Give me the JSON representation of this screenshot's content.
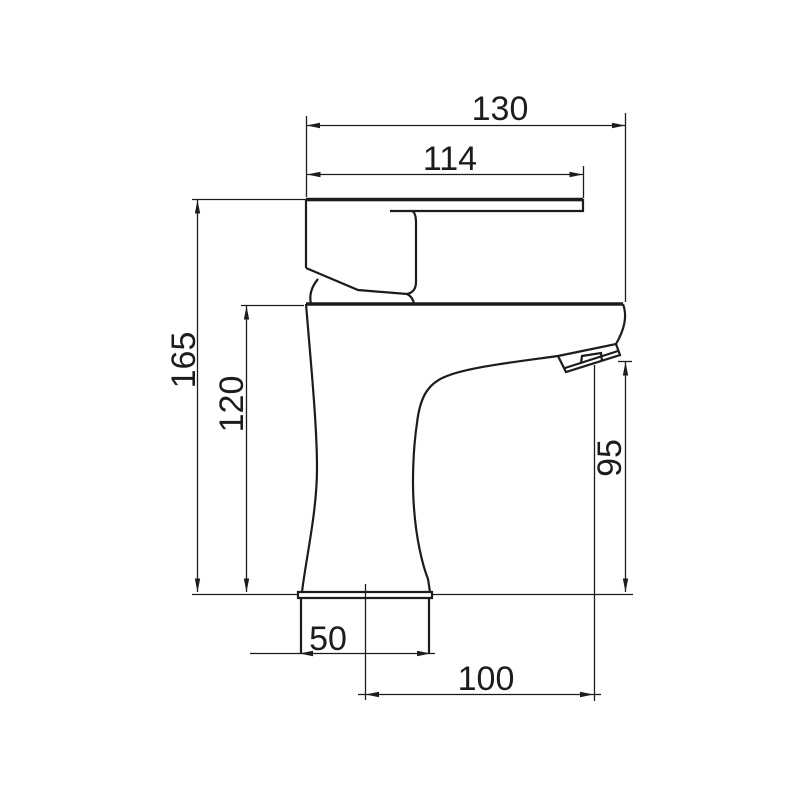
{
  "drawing": {
    "subject": "single-lever basin mixer tap, side elevation technical drawing",
    "background_color": "#ffffff",
    "line_color": "#1c1c1c"
  },
  "dimensions": {
    "overall_width": "130",
    "handle_width": "114",
    "overall_height": "165",
    "body_height": "120",
    "spout_height": "95",
    "base_width": "50",
    "spout_reach": "100"
  }
}
